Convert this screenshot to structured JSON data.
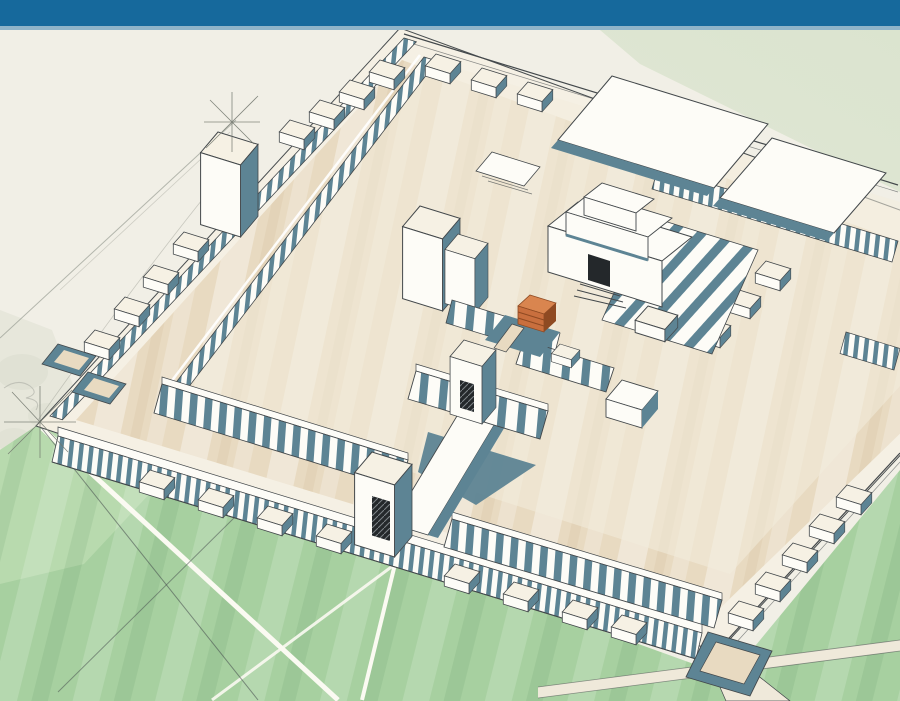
{
  "palette": {
    "header_blue": "#16699c",
    "header_underline": "#8fb4c9",
    "paper": "#f1efe6",
    "wash": "#ccd2c0",
    "pale_green": "#dbe4cf",
    "lawn": "#a7d0a0",
    "lawn_light": "#c6e1b9",
    "road_cream": "#efe9da",
    "path_white": "#fbfaf2",
    "tan": "#e8dac1",
    "tan_deep": "#d8c5a4",
    "cream": "#f6f1e4",
    "white": "#fdfcf7",
    "slate": "#5d8494",
    "slate_deep": "#46707f",
    "line": "#43484b",
    "pencil": "#8b8f85",
    "orange": "#c96f3e",
    "orange_light": "#d9854f",
    "orange_dark": "#8f4a22",
    "door": "#24282b"
  },
  "scene": {
    "header": {
      "label": "blue title bar"
    },
    "illustration": {
      "subject": "Aerial hand-drawn reconstruction sketch of a large walled temple complex: colonnaded outer walls with chamber blocks, corner and gate towers, a raised inner court with colonnades, a central stepped sanctuary with rear halls, an orange altar with ramp, and surrounding green fields crossed by white paths",
      "style": "ink and watercolor architectural sketch",
      "elements": [
        "outer terrace platform",
        "outer colonnaded walls",
        "chamber blocks along walls",
        "northwest corner tower",
        "south gate tower with dark doorway",
        "causeway to inner gate",
        "inner court colonnades",
        "west gate pylons",
        "inner south gate tower",
        "central sanctuary with stepped roof",
        "rear pillared halls",
        "altar with ramp",
        "south corner court",
        "green fields with white paths and roads",
        "pencil construction star marks"
      ]
    }
  }
}
